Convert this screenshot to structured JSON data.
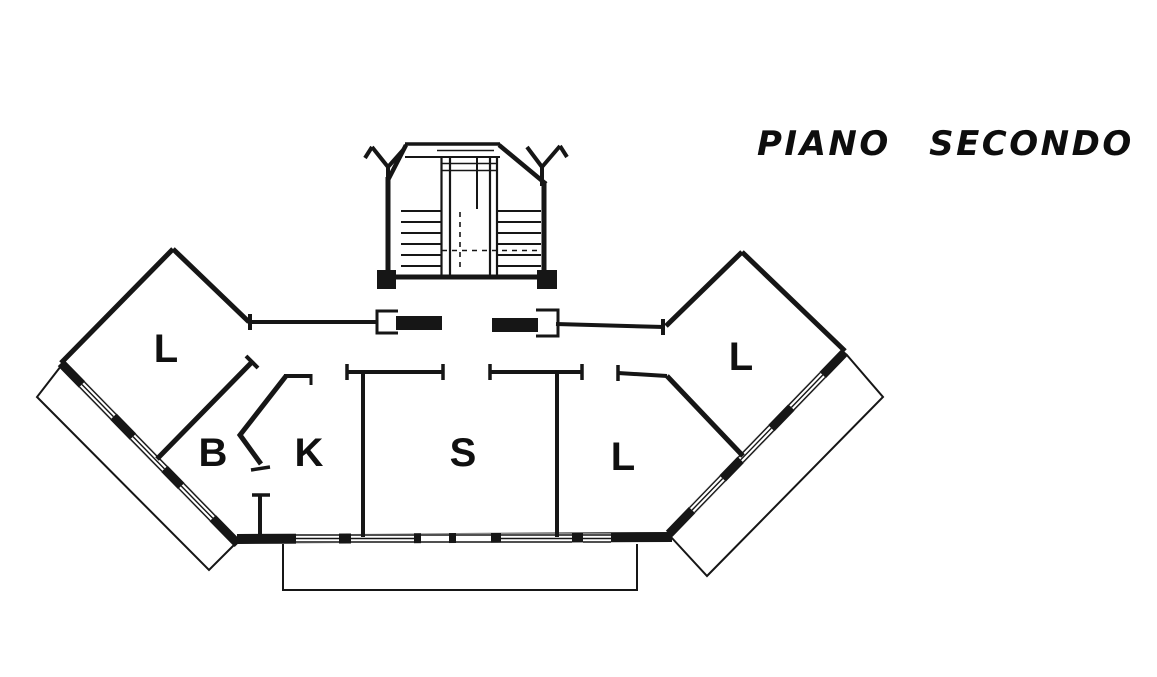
{
  "title": "PIANO SECONDO",
  "rooms": [
    {
      "key": "l-left-wing",
      "label": "L"
    },
    {
      "key": "b",
      "label": "B"
    },
    {
      "key": "k",
      "label": "K"
    },
    {
      "key": "s",
      "label": "S"
    },
    {
      "key": "l-center",
      "label": "L"
    },
    {
      "key": "l-right-wing",
      "label": "L"
    }
  ],
  "colors": {
    "ink": "#161616",
    "paper": "#ffffff"
  }
}
